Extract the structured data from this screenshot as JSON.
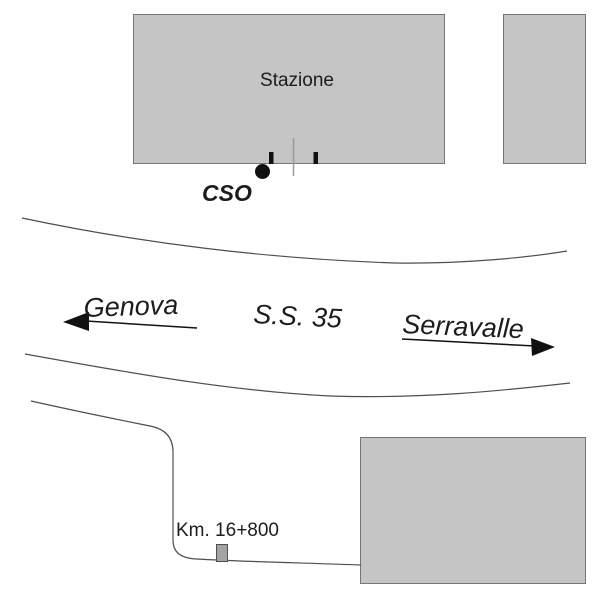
{
  "map": {
    "labels": {
      "station": "Stazione",
      "cso": "CSO",
      "destination_left": "Genova",
      "road": "S.S. 35",
      "destination_right": "Serravalle",
      "km": "Km. 16+800"
    },
    "colors": {
      "background": "#ffffff",
      "building_fill": "#c5c5c5",
      "building_border": "#757575",
      "road_line": "#4f4f4f",
      "arrow": "#111111",
      "marker_fill": "#a3a3a3",
      "marker_border": "#4f4f4f",
      "platform_line": "#9a9a9a",
      "text": "#1c1c1c"
    }
  }
}
